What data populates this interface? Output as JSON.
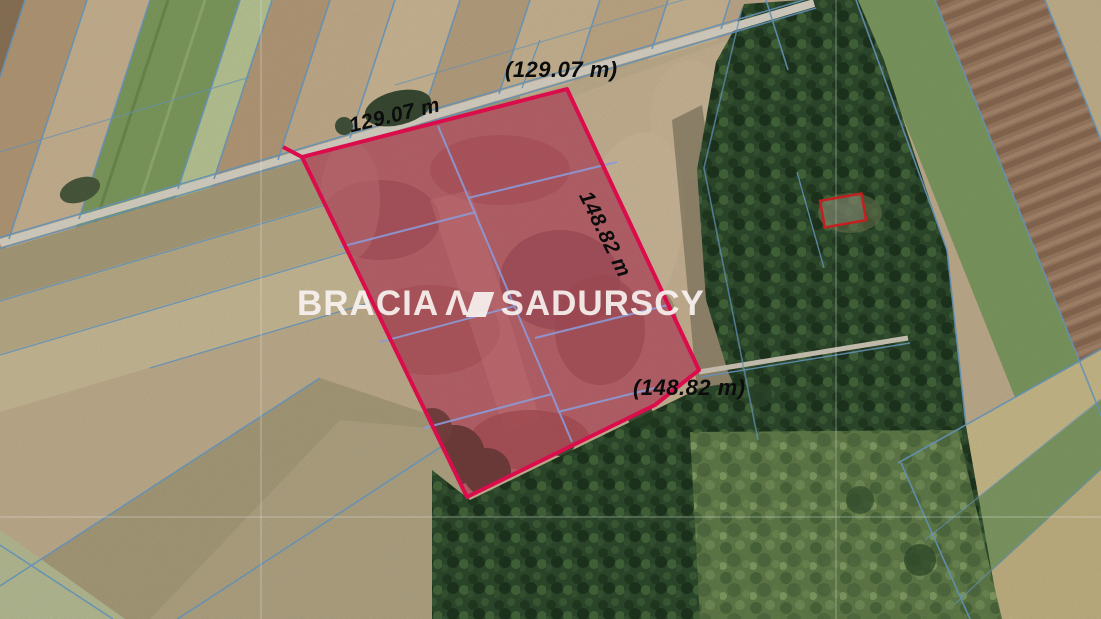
{
  "map": {
    "type": "satellite-cadastral-listing-image",
    "labels": {
      "top_road": "(129.07 m)",
      "top_edge": "129.07 m",
      "right_edge": "148.82 m",
      "bottom_edge": "(148.82 m)"
    },
    "watermark": {
      "first": "BRACIA",
      "second": "SADURSCY",
      "logo": "lambda-parallelogram-mark"
    },
    "colors": {
      "parcel_outline": "#ec0e52",
      "parcel_fill_overlay": "rgba(225,20,80,0.33)",
      "cadastral_line": "#6b9cc4",
      "inner_subdivision_line": "#98a6e8",
      "building_outline": "#d42222",
      "road": "#d9d4c6",
      "label_text": "#0c0c0c",
      "watermark_text": "#f7f1ef",
      "grid_line": "rgba(255,255,255,0.33)"
    }
  }
}
